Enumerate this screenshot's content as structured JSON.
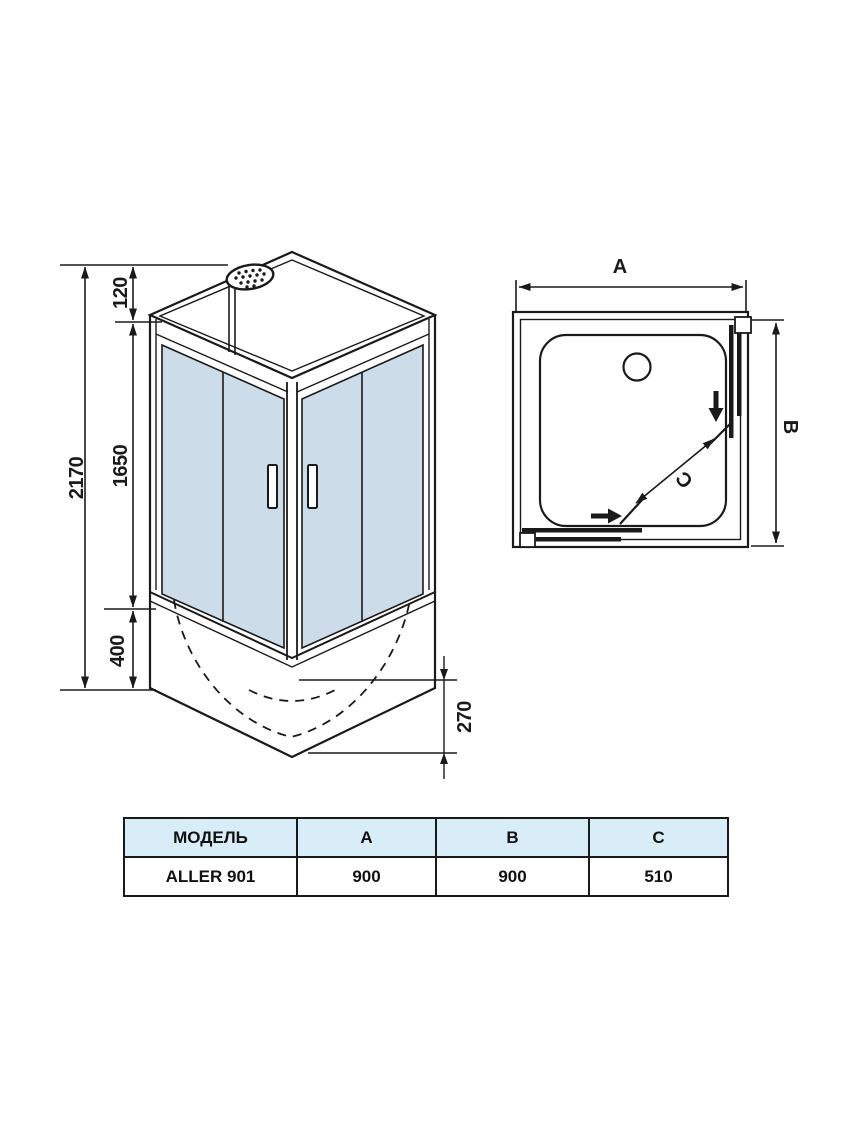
{
  "front_view": {
    "dim_total_height": "2170",
    "dim_top_offset": "120",
    "dim_glass_height": "1650",
    "dim_tray_height": "400",
    "dim_tray_depth": "270"
  },
  "top_view": {
    "dim_a": "A",
    "dim_b": "B",
    "dim_c": "C"
  },
  "table": {
    "headers": [
      "МОДЕЛЬ",
      "A",
      "B",
      "C"
    ],
    "rows": [
      [
        "ALLER 901",
        "900",
        "900",
        "510"
      ]
    ]
  },
  "colors": {
    "glass": "#ccdce9",
    "header_bg": "#d9edf8",
    "line": "#1a1a1a"
  }
}
